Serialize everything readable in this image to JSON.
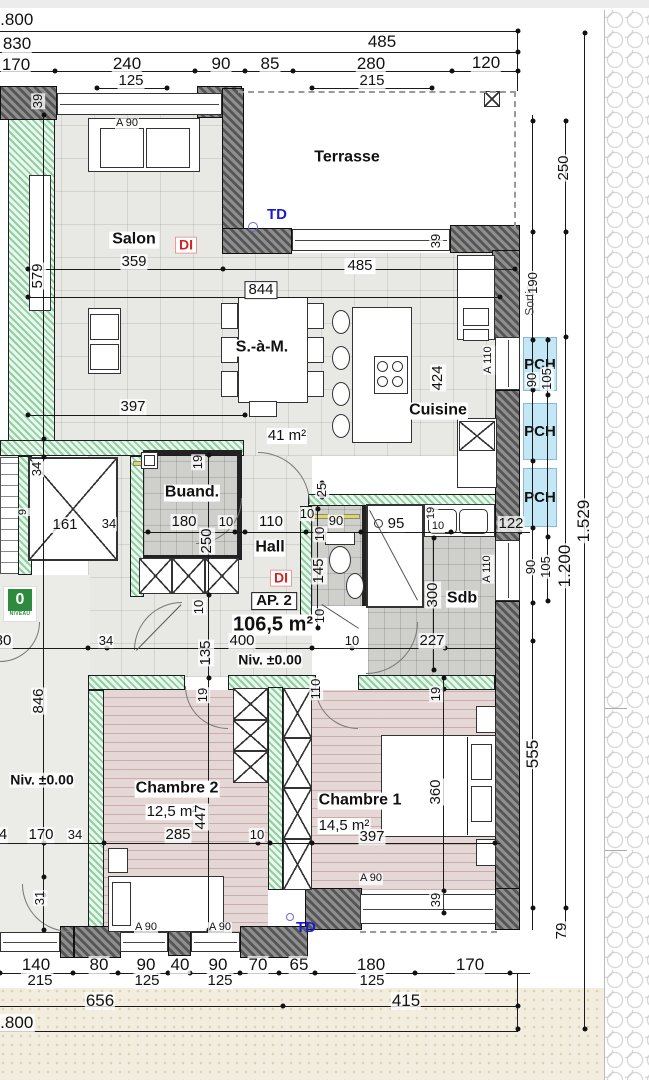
{
  "apartment": {
    "id": "AP. 2",
    "area": "106,5 m²",
    "level": "Niv. ±0.00",
    "di_label": "DI",
    "td_label": "TD"
  },
  "rooms": [
    {
      "name": "Terrasse"
    },
    {
      "name": "Salon",
      "dim": "359"
    },
    {
      "name": "S.-à-M."
    },
    {
      "name": "Cuisine",
      "area_shared": "41 m²"
    },
    {
      "name": "Buand."
    },
    {
      "name": "Hall"
    },
    {
      "name": "Sdb"
    },
    {
      "name": "Chambre 1",
      "area": "14,5 m²"
    },
    {
      "name": "Chambre 2",
      "area": "12,5 m²"
    }
  ],
  "window_codes": [
    "A 90",
    "A 110"
  ],
  "pch": {
    "label": "PCH"
  },
  "exit": {
    "label": "Sortie",
    "dim": "190"
  },
  "level_badge": {
    "value": "0",
    "caption": "NIVEAU"
  },
  "colors": {
    "pch_fill": "#c3e7f5",
    "td_blue": "#1b1bd6",
    "di_red": "#d42222",
    "wall_green": "#8fd0a0",
    "badge_green": "#2e8b3d"
  },
  "labels": [
    [
      "1.800",
      12,
      20,
      "m"
    ],
    [
      "830",
      17,
      44,
      "m"
    ],
    [
      "485",
      382,
      42,
      "m"
    ],
    [
      "170",
      16,
      65,
      "m"
    ],
    [
      "240",
      127,
      64,
      "m"
    ],
    [
      "90",
      221,
      64,
      "m"
    ],
    [
      "85",
      270,
      64,
      "m"
    ],
    [
      "280",
      371,
      64,
      "m"
    ],
    [
      "120",
      486,
      63,
      "m"
    ],
    [
      "125",
      131,
      81,
      ""
    ],
    [
      "215",
      372,
      81,
      ""
    ],
    [
      "39",
      38,
      101,
      "r s"
    ],
    [
      "A 90",
      127,
      124,
      "xs"
    ],
    [
      "Terrasse",
      347,
      158,
      "room"
    ],
    [
      "250",
      564,
      168,
      "r"
    ],
    [
      "TD",
      277,
      215,
      "td"
    ],
    [
      "Salon",
      134,
      240,
      "room boxed"
    ],
    [
      "DI",
      186,
      245,
      "di"
    ],
    [
      "359",
      134,
      262,
      ""
    ],
    [
      "579",
      38,
      276,
      "r"
    ],
    [
      "485",
      360,
      266,
      "boxed"
    ],
    [
      "844",
      261,
      290,
      "framed"
    ],
    [
      "39",
      436,
      241,
      "r s"
    ],
    [
      "Sortie",
      530,
      300,
      "sortie r"
    ],
    [
      "190",
      533,
      283,
      "r s"
    ],
    [
      "S.-à-M.",
      262,
      348,
      "room boxed"
    ],
    [
      "90",
      532,
      380,
      "r s"
    ],
    [
      "105",
      547,
      379,
      "r s"
    ],
    [
      "424",
      438,
      378,
      "r"
    ],
    [
      "A 110",
      489,
      360,
      "r xs"
    ],
    [
      "Cuisine",
      438,
      411,
      "room"
    ],
    [
      "41 m²",
      287,
      436,
      "area"
    ],
    [
      "397",
      133,
      407,
      ""
    ],
    [
      "1.529",
      584,
      521,
      "r m"
    ],
    [
      "Buand.",
      192,
      493,
      "room"
    ],
    [
      "19",
      198,
      462,
      "r s"
    ],
    [
      "180",
      184,
      522,
      ""
    ],
    [
      "250",
      207,
      541,
      "r"
    ],
    [
      "10",
      226,
      522,
      "s"
    ],
    [
      "110",
      271,
      522,
      ""
    ],
    [
      "Hall",
      270,
      548,
      "room"
    ],
    [
      "DI",
      281,
      578,
      "di"
    ],
    [
      "AP. 2",
      274,
      601,
      "ap"
    ],
    [
      "106,5 m²",
      273,
      625,
      "bigarea"
    ],
    [
      "400",
      242,
      641,
      ""
    ],
    [
      "Niv. ±0.00",
      270,
      660,
      "niv"
    ],
    [
      "135",
      206,
      653,
      "r"
    ],
    [
      "10",
      199,
      607,
      "r s"
    ],
    [
      "34",
      106,
      641,
      "s"
    ],
    [
      "80",
      3,
      641,
      ""
    ],
    [
      "161",
      65,
      525,
      ""
    ],
    [
      "34",
      109,
      524,
      "s"
    ],
    [
      "34",
      37,
      469,
      "r s"
    ],
    [
      "9",
      24,
      512,
      "r xs"
    ],
    [
      "25",
      322,
      490,
      "r s"
    ],
    [
      "10",
      307,
      514,
      "s"
    ],
    [
      "90",
      336,
      521,
      "s"
    ],
    [
      "10",
      320,
      534,
      "r s"
    ],
    [
      "145",
      319,
      571,
      "r"
    ],
    [
      "10",
      320,
      616,
      "r s"
    ],
    [
      "95",
      396,
      524,
      ""
    ],
    [
      "19",
      432,
      513,
      "r xs"
    ],
    [
      "10",
      438,
      527,
      "xs"
    ],
    [
      "122",
      511,
      524,
      ""
    ],
    [
      "A 110",
      488,
      569,
      "r xs"
    ],
    [
      "90",
      531,
      567,
      "r s"
    ],
    [
      "105",
      546,
      567,
      "r s"
    ],
    [
      "1.200",
      565,
      566,
      "r m"
    ],
    [
      "300",
      433,
      595,
      "r"
    ],
    [
      "Sdb",
      462,
      599,
      "room"
    ],
    [
      "227",
      432,
      641,
      ""
    ],
    [
      "10",
      352,
      641,
      "s"
    ],
    [
      "846",
      39,
      701,
      "r"
    ],
    [
      "Niv. ±0.00",
      42,
      780,
      "niv"
    ],
    [
      "19",
      203,
      695,
      "r s"
    ],
    [
      "110",
      316,
      689,
      "r s"
    ],
    [
      "19",
      436,
      694,
      "r s"
    ],
    [
      "Chambre 2",
      177,
      789,
      "room"
    ],
    [
      "12,5 m²",
      172,
      812,
      "area"
    ],
    [
      "447",
      201,
      817,
      "r"
    ],
    [
      "285",
      178,
      835,
      ""
    ],
    [
      "10",
      257,
      835,
      "s"
    ],
    [
      "Chambre 1",
      360,
      801,
      "room"
    ],
    [
      "14,5 m²",
      344,
      826,
      "area"
    ],
    [
      "397",
      372,
      837,
      ""
    ],
    [
      "360",
      436,
      792,
      "r"
    ],
    [
      "4",
      3,
      835,
      ""
    ],
    [
      "170",
      41,
      835,
      ""
    ],
    [
      "34",
      75,
      835,
      "s"
    ],
    [
      "31",
      40,
      898,
      "r s"
    ],
    [
      "A 90",
      146,
      928,
      "xs"
    ],
    [
      "A 90",
      220,
      928,
      "xs"
    ],
    [
      "A 90",
      371,
      879,
      "xs"
    ],
    [
      "TD",
      306,
      928,
      "td"
    ],
    [
      "39",
      436,
      900,
      "r s"
    ],
    [
      "555",
      533,
      754,
      "r m"
    ],
    [
      "79",
      562,
      931,
      "r"
    ],
    [
      "140",
      36,
      965,
      "m"
    ],
    [
      "80",
      99,
      965,
      "m"
    ],
    [
      "90",
      146,
      965,
      "m"
    ],
    [
      "40",
      180,
      965,
      "m"
    ],
    [
      "90",
      218,
      965,
      "m"
    ],
    [
      "70",
      258,
      965,
      "m"
    ],
    [
      "65",
      299,
      965,
      "m"
    ],
    [
      "180",
      371,
      965,
      "m"
    ],
    [
      "170",
      470,
      965,
      "m"
    ],
    [
      "215",
      40,
      981,
      ""
    ],
    [
      "125",
      147,
      981,
      ""
    ],
    [
      "125",
      220,
      981,
      ""
    ],
    [
      "125",
      372,
      981,
      ""
    ],
    [
      "656",
      100,
      1001,
      "m"
    ],
    [
      "415",
      406,
      1001,
      "m"
    ],
    [
      "1.800",
      12,
      1023,
      "m"
    ]
  ]
}
